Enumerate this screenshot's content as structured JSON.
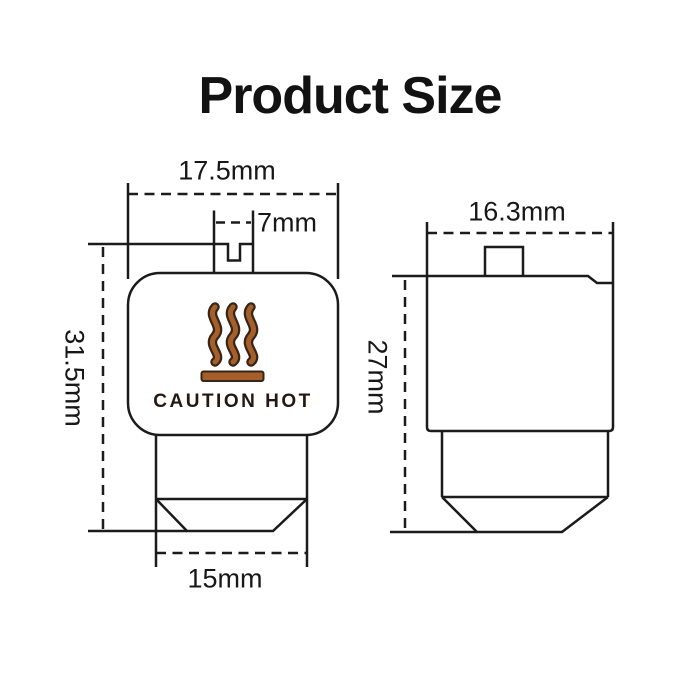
{
  "title": "Product Size",
  "front_view": {
    "width_label": "17.5mm",
    "slot_width_label": "7mm",
    "height_label": "31.5mm",
    "nozzle_width_label": "15mm",
    "caution_label": "CAUTION HOT",
    "icon": "heat-waves-icon"
  },
  "side_view": {
    "width_label": "16.3mm",
    "height_label": "27mm"
  },
  "colors": {
    "line": "#1b1b1b",
    "text": "#171717",
    "heat_wave_fill": "#a55f2b",
    "heat_wave_outline": "#382515",
    "caution_text": "#241812",
    "background": "#ffffff"
  }
}
